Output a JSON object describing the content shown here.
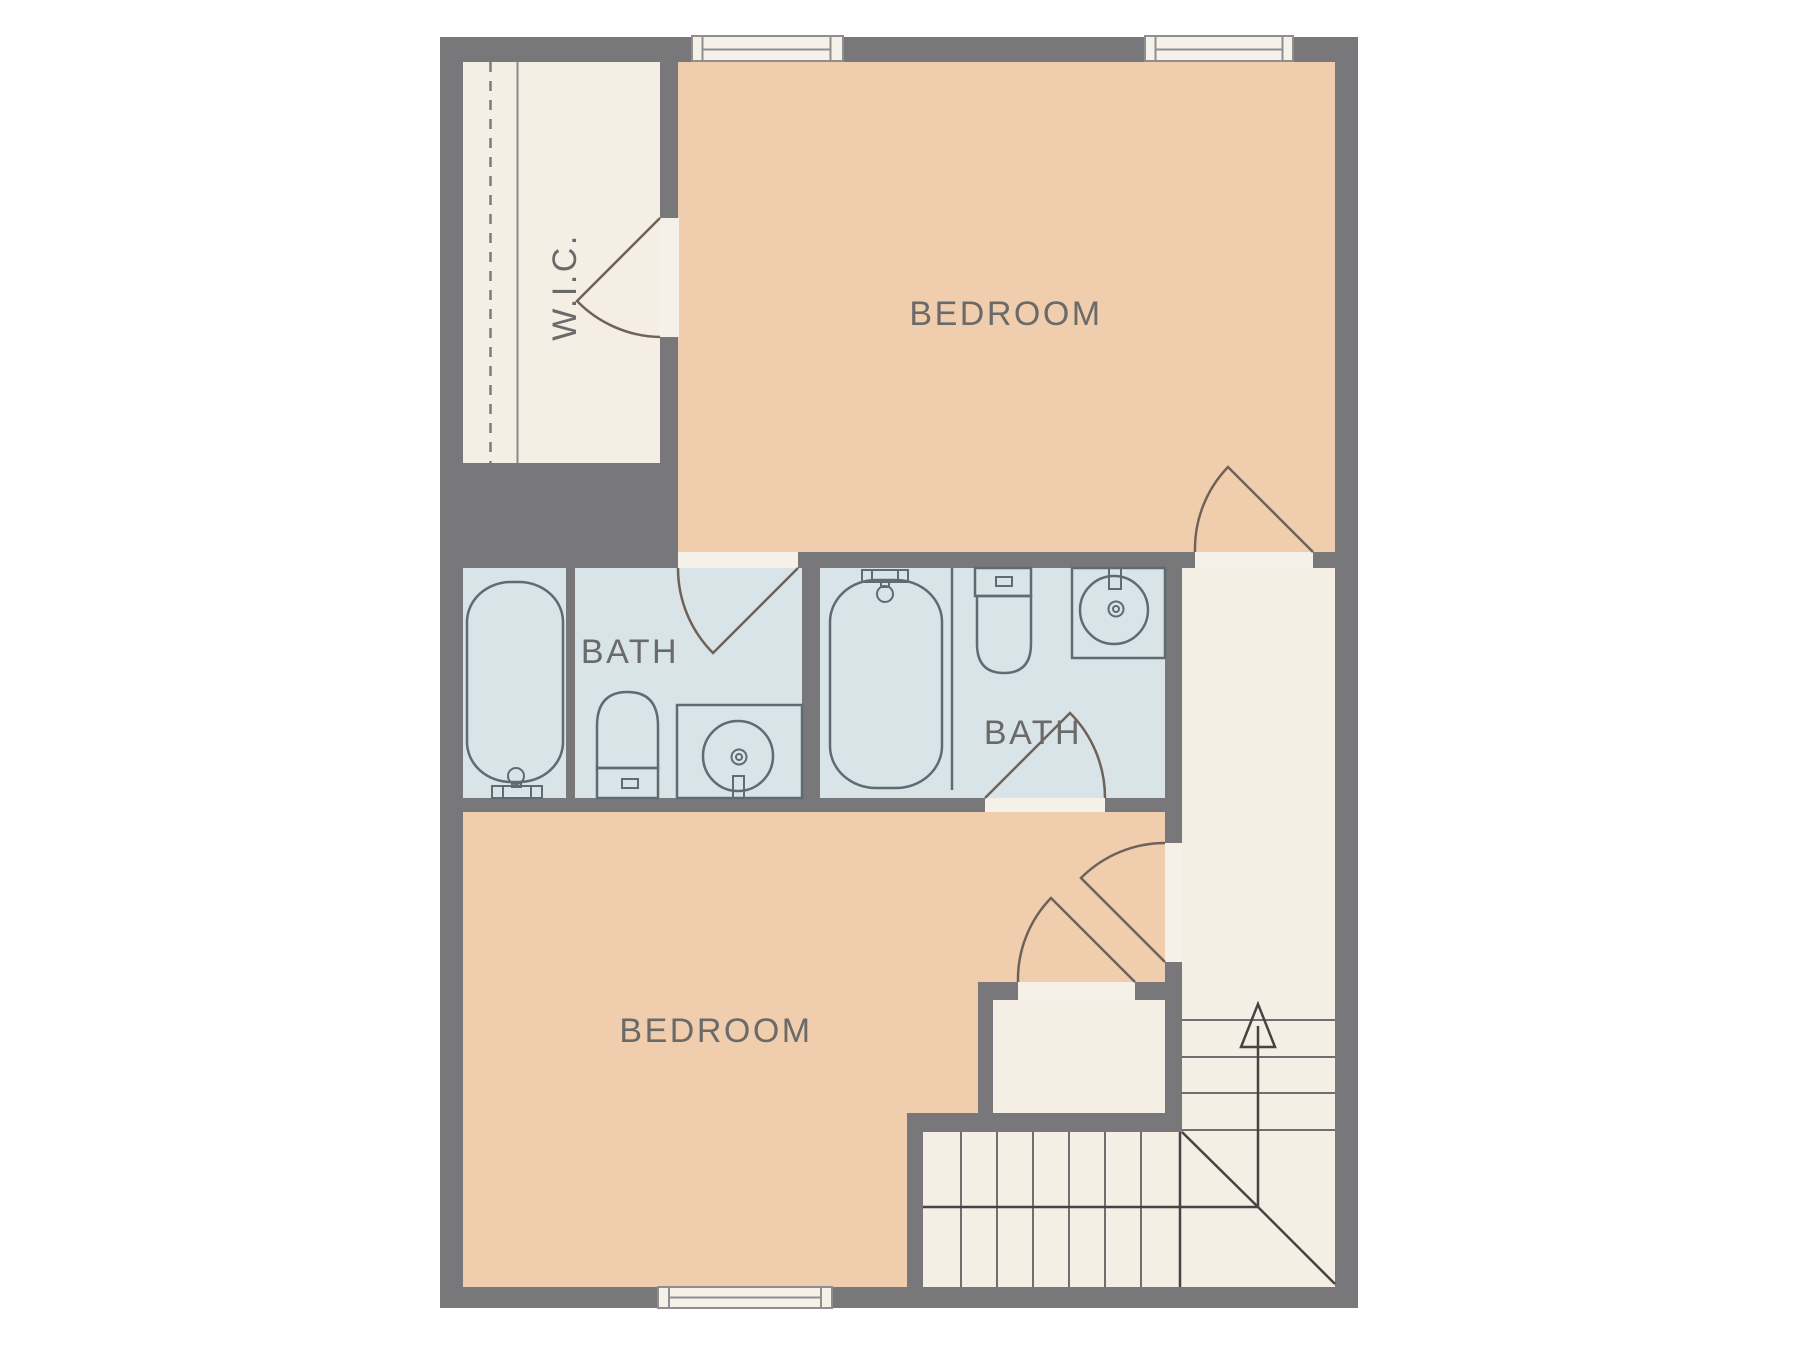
{
  "plan": {
    "title": "Upper floor plan with two bedrooms, two baths, walk-in closet and staircase",
    "labels": {
      "wic": "W.I.C.",
      "bedroom_top": "BEDROOM",
      "bedroom_bottom": "BEDROOM",
      "bath_left": "BATH",
      "bath_right": "BATH"
    },
    "colors": {
      "wall": "#78787b",
      "bedroom-floor": "#f0cead",
      "bath-floor": "#d9e4e8",
      "hall-floor": "#f4eee5",
      "opening": "#f5f0e8",
      "fixture-stroke": "#5f6b72",
      "door-stroke": "#6e6259",
      "label": "#6a6a6a",
      "stair-line": "#6f6f6f",
      "stair-rail": "#474344"
    }
  }
}
